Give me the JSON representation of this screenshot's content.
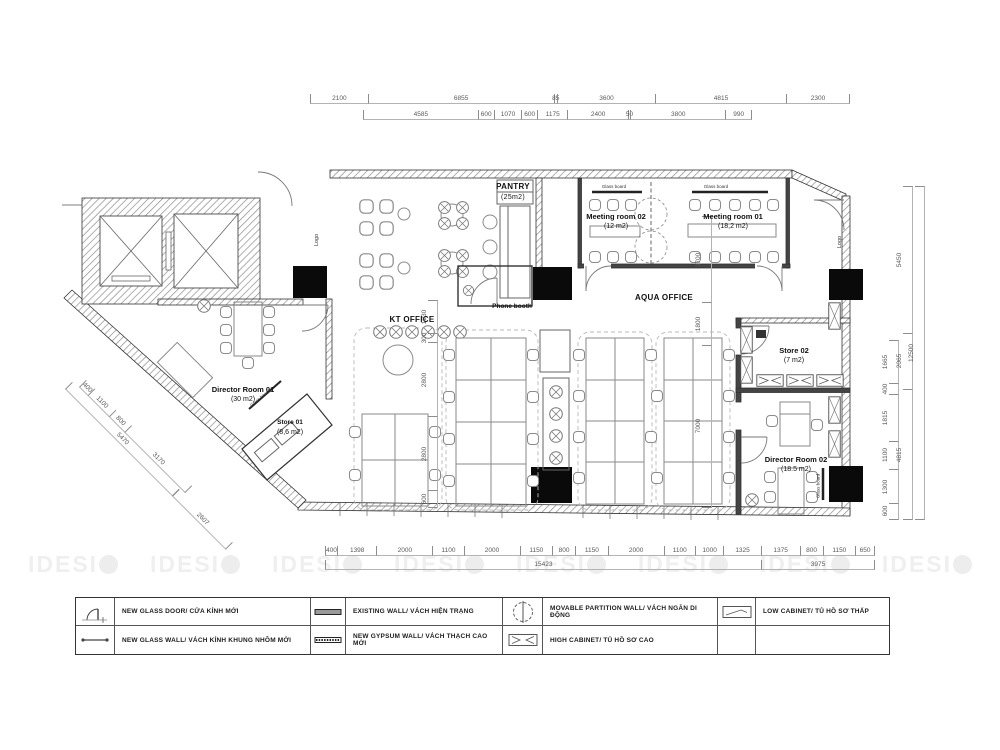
{
  "watermark": {
    "text": "IDESI"
  },
  "rooms": {
    "pantry": {
      "name": "PANTRY",
      "area": "(25m2)"
    },
    "meeting2": {
      "name": "Meeting room 02",
      "area": "(12 m2)"
    },
    "meeting1": {
      "name": "Meeting room 01",
      "area": "(18,2 m2)"
    },
    "aqua": {
      "name": "AQUA OFFICE"
    },
    "kt": {
      "name": "KT OFFICE"
    },
    "phone": {
      "name": "Phone booth"
    },
    "dr1": {
      "name": "Director Room 01",
      "area": "(30 m2)"
    },
    "store1": {
      "name": "Store 01",
      "area": "(8,6 m2)"
    },
    "store2": {
      "name": "Store 02",
      "area": "(7 m2)"
    },
    "dr2": {
      "name": "Director Room 02",
      "area": "(18.5 m2)"
    }
  },
  "labels": {
    "logo": "Logo",
    "glass_board": "Glass board"
  },
  "dims": {
    "top1": [
      "2100",
      "6855",
      "85",
      "3600",
      "4815",
      "2300"
    ],
    "top2": [
      "4585",
      "600",
      "1070",
      "600",
      "1175",
      "2400",
      "50",
      "3800",
      "990"
    ],
    "bottom1": [
      "400",
      "1398",
      "2000",
      "1100",
      "2000",
      "1150",
      "800",
      "1150",
      "2000",
      "1100",
      "1000",
      "1325",
      "1375",
      "800",
      "1150",
      "650"
    ],
    "bottom2": [
      "15423",
      "3975"
    ],
    "right_detail": [
      "1665",
      "400",
      "1815",
      "1100",
      "1300",
      "600"
    ],
    "right_mid": [
      "5450",
      "2065",
      "4815"
    ],
    "right_total": [
      "12500"
    ],
    "left_diag": [
      "400",
      "1100",
      "800",
      "3170"
    ],
    "left_diag_total": [
      "5470"
    ],
    "left_diag_ext": [
      "2607"
    ],
    "interior_left": [
      "1230",
      "300",
      "2800",
      "2800",
      "600"
    ],
    "interior_right": [
      "3700",
      "1800",
      "7000"
    ]
  },
  "legend": {
    "items": [
      {
        "symbol": "glass-door-icon",
        "label": "NEW GLASS DOOR/ CỬA KÍNH MỚI"
      },
      {
        "symbol": "existing-wall-icon",
        "label": "EXISTING WALL/ VÁCH HIỆN TRẠNG"
      },
      {
        "symbol": "movable-partition-icon",
        "label": "MOVABLE PARTITION WALL/ VÁCH NGĂN DI ĐỘNG"
      },
      {
        "symbol": "low-cabinet-icon",
        "label": "LOW CABINET/ TỦ HỒ SƠ THẤP"
      },
      {
        "symbol": "glass-wall-icon",
        "label": "NEW GLASS WALL/ VÁCH KÍNH KHUNG NHÔM MỚI"
      },
      {
        "symbol": "gypsum-wall-icon",
        "label": "NEW GYPSUM WALL/ VÁCH THẠCH CAO MỚI"
      },
      {
        "symbol": "high-cabinet-icon",
        "label": "HIGH CABINET/ TỦ HỒ SƠ CAO"
      },
      {
        "symbol": "",
        "label": ""
      }
    ]
  }
}
